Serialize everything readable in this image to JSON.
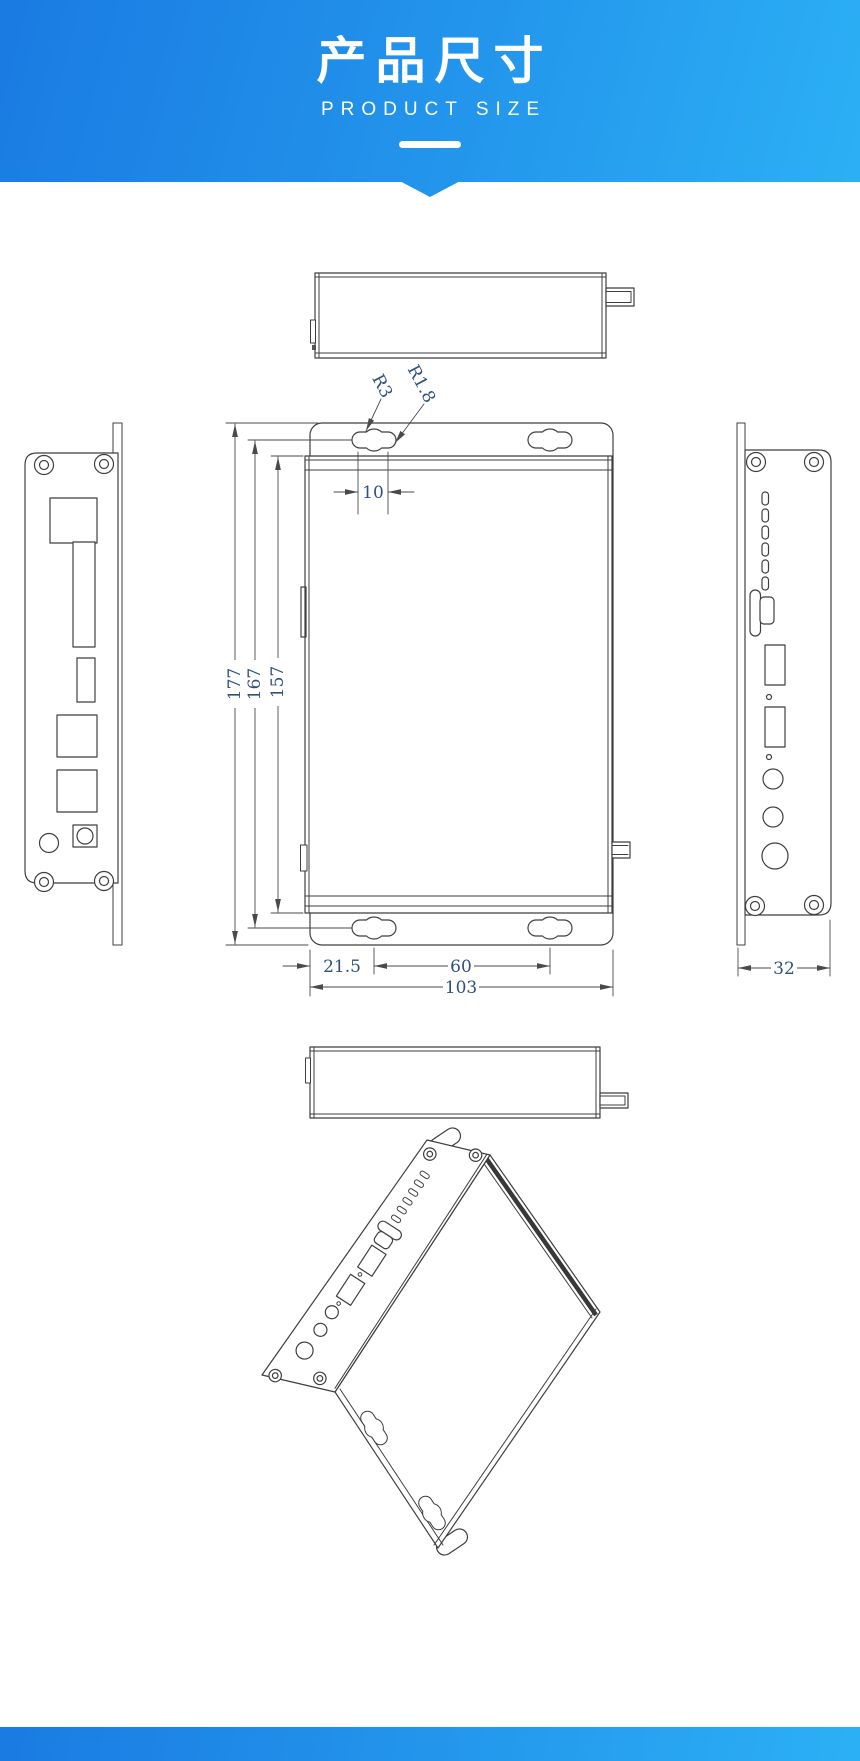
{
  "header": {
    "title": "产品尺寸",
    "subtitle": "PRODUCT SIZE"
  },
  "dimensions": {
    "total_height": "177",
    "mount_slot_span_vertical": "167",
    "body_height": "157",
    "slot_length": "10",
    "slot_radius_large": "R3",
    "slot_radius_small": "R1.8",
    "edge_to_slot": "21.5",
    "mount_slot_span_horizontal": "60",
    "total_width": "103",
    "depth": "32"
  },
  "colors": {
    "banner_gradient_start": "#1a7be2",
    "banner_gradient_end": "#2cb0f5",
    "drawing_line": "#3f3f3f",
    "dimension_text": "#31507e"
  }
}
